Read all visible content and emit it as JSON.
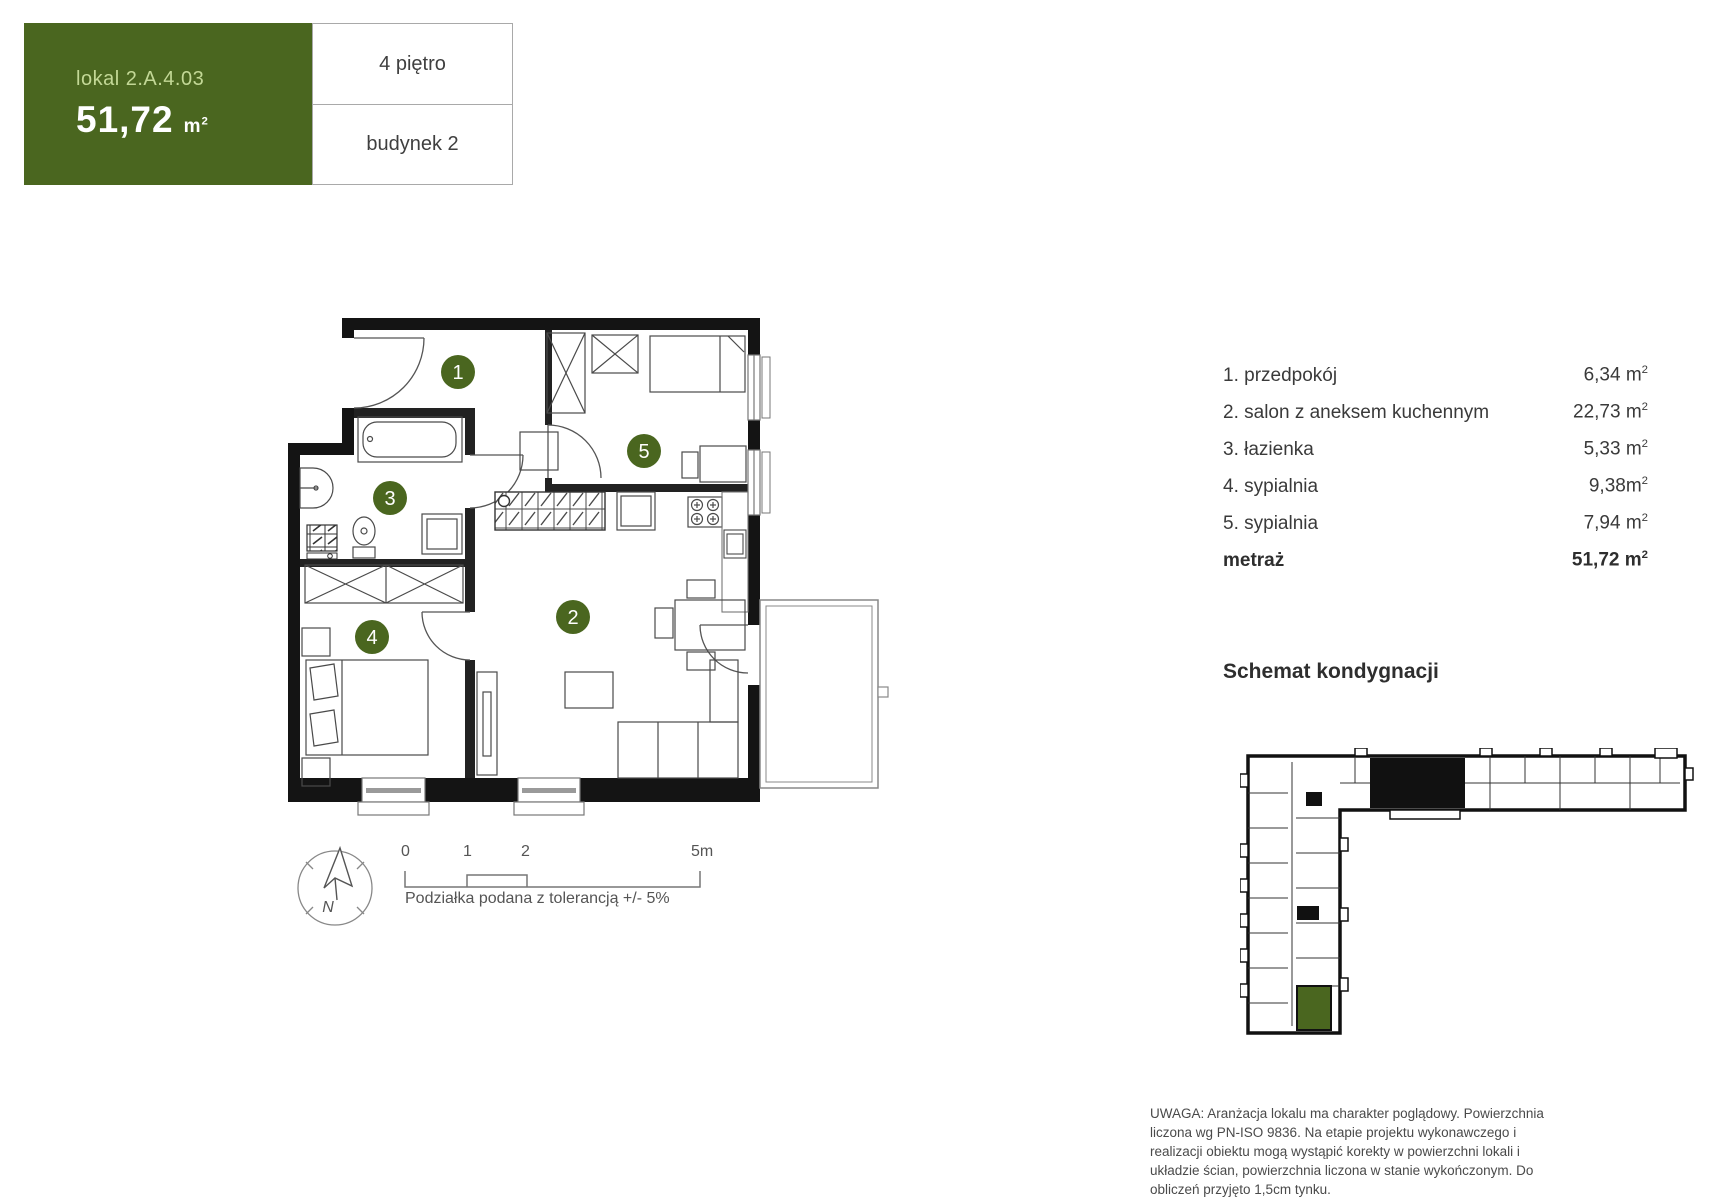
{
  "header": {
    "unit_label": "lokal 2.A.4.03",
    "area_value": "51,72",
    "area_unit": "m",
    "area_sup": "2",
    "floor": "4 piętro",
    "building": "budynek 2"
  },
  "rooms": {
    "items": [
      {
        "label": "1. przedpokój",
        "value": "6,34 m",
        "sup": "2"
      },
      {
        "label": "2. salon z aneksem kuchennym",
        "value": "22,73 m",
        "sup": "2"
      },
      {
        "label": "3. łazienka",
        "value": "5,33 m",
        "sup": "2"
      },
      {
        "label": "4. sypialnia",
        "value": "9,38m",
        "sup": "2"
      },
      {
        "label": "5. sypialnia",
        "value": "7,94 m",
        "sup": "2"
      }
    ],
    "total_label": "metraż",
    "total_value": "51,72 m",
    "total_sup": "2"
  },
  "plan": {
    "room_numbers": [
      "1",
      "2",
      "3",
      "4",
      "5"
    ]
  },
  "compass": {
    "north_label": "N"
  },
  "scale": {
    "t0": "0",
    "t1": "1",
    "t2": "2",
    "t5": "5m",
    "note": "Podziałka podana z tolerancją +/- 5%"
  },
  "schematic": {
    "title": "Schemat kondygnacji"
  },
  "disclaimer": "UWAGA: Aranżacja lokalu ma charakter poglądowy. Powierzchnia liczona wg PN-ISO 9836. Na etapie projektu wykonawczego i realizacji obiektu mogą wystąpić korekty w powierzchni lokali i układzie ścian, powierzchnia liczona w stanie wykończonym. Do obliczeń przyjęto 1,5cm tynku.",
  "colors": {
    "accent_green": "#4a661f",
    "pale_green_text": "#c3d896",
    "wall_black": "#141414",
    "text_dark": "#3a3a3a",
    "muted_gray": "#777777"
  }
}
